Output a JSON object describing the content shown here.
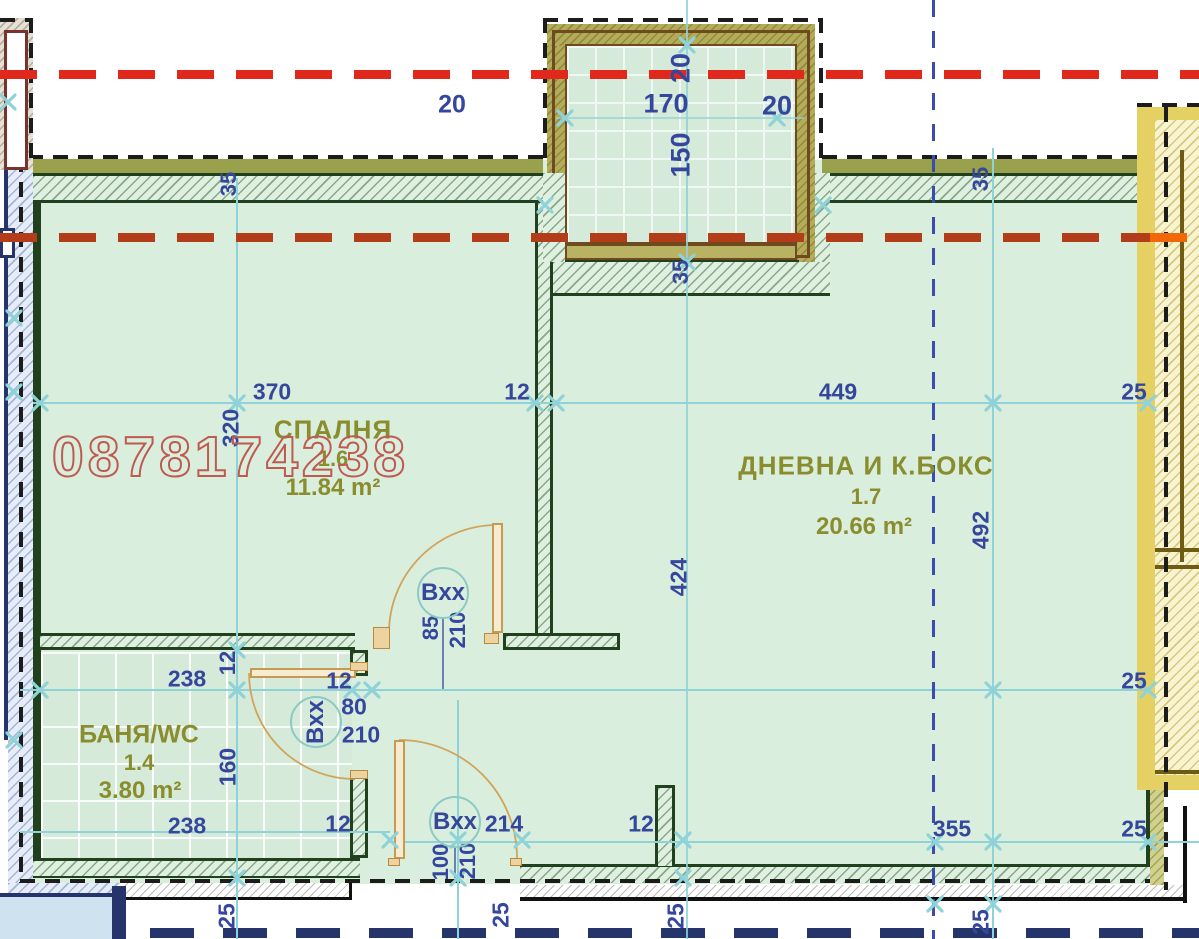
{
  "title": "Apartment floor plan",
  "watermark": {
    "text": "0878174238",
    "color": "#bf5a50"
  },
  "rooms": {
    "bedroom": {
      "name": "СПАЛНЯ",
      "number": "1.6",
      "area": "11.84 m²"
    },
    "living": {
      "name": "ДНЕВНА И К.БОКС",
      "number": "1.7",
      "area": "20.66 m²"
    },
    "bath": {
      "name": "БАНЯ/WC",
      "number": "1.4",
      "area": "3.80 m²"
    }
  },
  "door_tags": [
    {
      "label": "Bxx",
      "x": 443,
      "y": 593,
      "rot": 0
    },
    {
      "label": "Bxx",
      "x": 316,
      "y": 722,
      "rot": -90
    },
    {
      "label": "Bxx",
      "x": 455,
      "y": 822,
      "rot": 0
    }
  ],
  "dimensions": [
    {
      "t": "20",
      "x": 452,
      "y": 105,
      "r": 0,
      "s": 25
    },
    {
      "t": "170",
      "x": 666,
      "y": 104,
      "r": 0,
      "s": 27
    },
    {
      "t": "20",
      "x": 777,
      "y": 106,
      "r": 0,
      "s": 27
    },
    {
      "t": "20",
      "x": 681,
      "y": 68,
      "r": -90,
      "s": 27
    },
    {
      "t": "150",
      "x": 681,
      "y": 155,
      "r": -90,
      "s": 27
    },
    {
      "t": "35",
      "x": 681,
      "y": 272,
      "r": -90,
      "s": 22
    },
    {
      "t": "35",
      "x": 229,
      "y": 184,
      "r": -90,
      "s": 22
    },
    {
      "t": "35",
      "x": 981,
      "y": 179,
      "r": -90,
      "s": 22
    },
    {
      "t": "370",
      "x": 272,
      "y": 392,
      "r": 0,
      "s": 23
    },
    {
      "t": "12",
      "x": 517,
      "y": 392,
      "r": 0,
      "s": 23
    },
    {
      "t": "449",
      "x": 838,
      "y": 392,
      "r": 0,
      "s": 23
    },
    {
      "t": "25",
      "x": 1134,
      "y": 392,
      "r": 0,
      "s": 23
    },
    {
      "t": "320",
      "x": 231,
      "y": 428,
      "r": -90,
      "s": 23
    },
    {
      "t": "492",
      "x": 981,
      "y": 530,
      "r": -90,
      "s": 23
    },
    {
      "t": "424",
      "x": 679,
      "y": 577,
      "r": -90,
      "s": 23
    },
    {
      "t": "85",
      "x": 431,
      "y": 628,
      "r": -90,
      "s": 22
    },
    {
      "t": "210",
      "x": 458,
      "y": 630,
      "r": -90,
      "s": 22
    },
    {
      "t": "238",
      "x": 187,
      "y": 679,
      "r": 0,
      "s": 23
    },
    {
      "t": "12",
      "x": 228,
      "y": 663,
      "r": -90,
      "s": 22
    },
    {
      "t": "12",
      "x": 339,
      "y": 681,
      "r": 0,
      "s": 23
    },
    {
      "t": "80",
      "x": 354,
      "y": 707,
      "r": 0,
      "s": 23
    },
    {
      "t": "210",
      "x": 361,
      "y": 735,
      "r": 0,
      "s": 23
    },
    {
      "t": "25",
      "x": 1134,
      "y": 681,
      "r": 0,
      "s": 23
    },
    {
      "t": "160",
      "x": 228,
      "y": 767,
      "r": -90,
      "s": 23
    },
    {
      "t": "238",
      "x": 187,
      "y": 826,
      "r": 0,
      "s": 23
    },
    {
      "t": "12",
      "x": 338,
      "y": 824,
      "r": 0,
      "s": 23
    },
    {
      "t": "214",
      "x": 504,
      "y": 824,
      "r": 0,
      "s": 23
    },
    {
      "t": "12",
      "x": 641,
      "y": 824,
      "r": 0,
      "s": 23
    },
    {
      "t": "355",
      "x": 952,
      "y": 829,
      "r": 0,
      "s": 23
    },
    {
      "t": "25",
      "x": 1134,
      "y": 829,
      "r": 0,
      "s": 23
    },
    {
      "t": "100",
      "x": 441,
      "y": 862,
      "r": -90,
      "s": 22
    },
    {
      "t": "210",
      "x": 468,
      "y": 861,
      "r": -90,
      "s": 22
    },
    {
      "t": "25",
      "x": 227,
      "y": 916,
      "r": -90,
      "s": 23
    },
    {
      "t": "25",
      "x": 501,
      "y": 915,
      "r": -90,
      "s": 23
    },
    {
      "t": "25",
      "x": 676,
      "y": 916,
      "r": -90,
      "s": 23
    },
    {
      "t": "25",
      "x": 981,
      "y": 922,
      "r": -90,
      "s": 23
    }
  ],
  "ticks": [
    [
      40,
      403
    ],
    [
      237,
      403
    ],
    [
      535,
      403
    ],
    [
      556,
      403
    ],
    [
      993,
      403
    ],
    [
      1148,
      403
    ],
    [
      237,
      650
    ],
    [
      40,
      690
    ],
    [
      237,
      690
    ],
    [
      352,
      690
    ],
    [
      372,
      690
    ],
    [
      993,
      690
    ],
    [
      1148,
      690
    ],
    [
      390,
      840
    ],
    [
      458,
      840
    ],
    [
      522,
      840
    ],
    [
      683,
      840
    ],
    [
      935,
      842
    ],
    [
      993,
      842
    ],
    [
      1148,
      842
    ],
    [
      237,
      878
    ],
    [
      458,
      878
    ],
    [
      683,
      878
    ],
    [
      935,
      904
    ],
    [
      993,
      904
    ],
    [
      687,
      45
    ],
    [
      565,
      118
    ],
    [
      777,
      118
    ],
    [
      687,
      262
    ],
    [
      8,
      102
    ],
    [
      14,
      318
    ],
    [
      14,
      392
    ],
    [
      14,
      740
    ],
    [
      545,
      205
    ],
    [
      823,
      205
    ]
  ],
  "colors": {
    "wall_dark_green": "#20401e",
    "room_fill": "#daeedd",
    "tile_fill": "#d5ead8",
    "olive_band": "#9aa14c",
    "sill_olive": "#b9b263",
    "frame_brown": "#6f4a1f",
    "red_line_top": "#e0281c",
    "red_line_mid": "#b23d18",
    "orange_tail": "#f26808",
    "black_dash": "#1c1c1c",
    "neighbor_navy": "#26346c",
    "axis_blue": "#3c4bb0",
    "dim_line_cyan": "#8fd2d8",
    "dim_text_blue": "#35479c",
    "room_label_olive": "#8a8d2e",
    "watermark_red": "#bf5a50",
    "neighbor_yellow": "#e5d163",
    "pale_blue_room": "#cfe2ef"
  }
}
